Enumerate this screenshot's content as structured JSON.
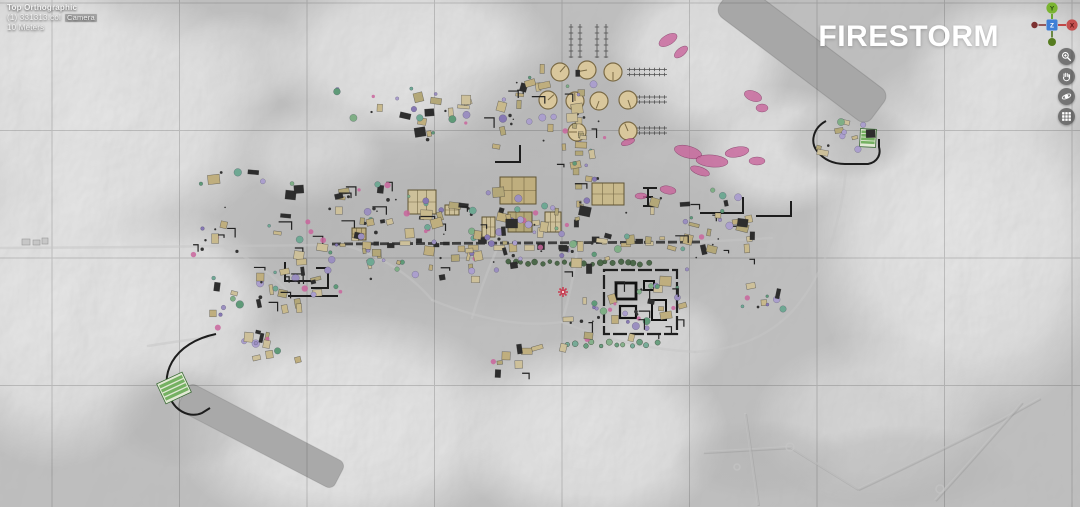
{
  "viewport": {
    "view_mode": "Top Orthographic",
    "selection": "(1) 331313.col",
    "camera_label": "Camera",
    "scale_label": "10 Meters"
  },
  "title": "FIRESTORM",
  "axis_gizmo": {
    "x_label": "X",
    "y_label": "Y",
    "z_label": "Z",
    "x_color": "#c4504f",
    "y_color": "#7ab431",
    "z_color": "#3e7fd6",
    "neg_x_color": "#7c3131",
    "neg_y_color": "#567c20"
  },
  "toolbar": {
    "buttons": [
      {
        "icon": "zoom-in-icon",
        "action": "zoom"
      },
      {
        "icon": "pan-hand-icon",
        "action": "pan"
      },
      {
        "icon": "orbit-icon",
        "action": "orbit"
      },
      {
        "icon": "grid-icon",
        "action": "toggle-grid"
      }
    ]
  },
  "map": {
    "colors": {
      "terrain_base": "#adadad",
      "runway": "#a7a7a7",
      "grid_line": "#3c3c3c",
      "tan": [
        "#c8b98c",
        "#bfae7e",
        "#cdc09a",
        "#b3a778"
      ],
      "dark_building": "#2d2d2d",
      "purple": [
        "#9b8fc0",
        "#ab9fcd",
        "#8678b3"
      ],
      "green": [
        "#7fae85",
        "#5f9a78",
        "#6fa893"
      ],
      "tree_green": "#41603f",
      "pink": "#c9659c",
      "tank_fill": "#d9c79c",
      "tank_stroke": "#7a6a45",
      "wall": "#1d1d1d",
      "road_dark": "#2b2b2b",
      "road_light": "#c6c6c6",
      "field_green": "#6fae5c",
      "field_base": "#e2e9d5",
      "red_marker": "#c84054"
    }
  }
}
